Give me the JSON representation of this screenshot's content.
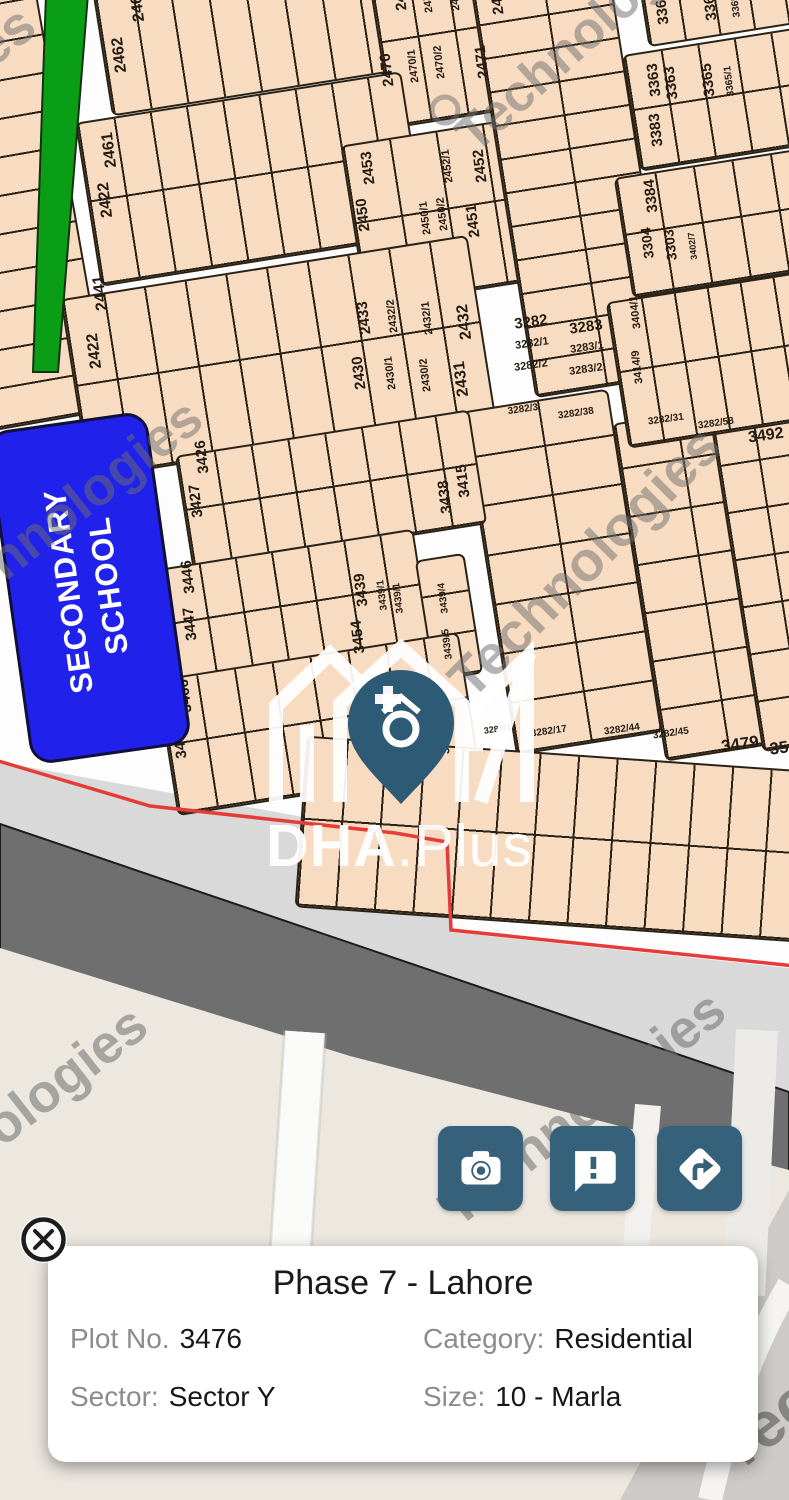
{
  "watermark": {
    "text": "Technologies"
  },
  "logo": {
    "bold": "DHA",
    "rest": ".Plus"
  },
  "school": {
    "line1": "SECONDARY",
    "line2": "SCHOOL"
  },
  "colors": {
    "plot_fill": "#f8dcc2",
    "plot_border": "#2a2216",
    "green_strip": "#0a9e17",
    "school_blue": "#2121ec",
    "road_dark": "#6f6f6f",
    "road_light": "#d9d9d9",
    "ground_beige": "#ece8e0",
    "boundary_red": "#e63c38",
    "button_teal": "#35617b"
  },
  "actions": [
    {
      "label": "camera",
      "icon": "camera-icon"
    },
    {
      "label": "feedback",
      "icon": "chat-exclaim-icon"
    },
    {
      "label": "directions",
      "icon": "turn-right-icon"
    }
  ],
  "info_card": {
    "title": "Phase 7 - Lahore",
    "fields": [
      {
        "label": "Plot No.",
        "value": "3476"
      },
      {
        "label": "Category:",
        "value": "Residential"
      },
      {
        "label": "Sector:",
        "value": "Sector Y"
      },
      {
        "label": "Size:",
        "value": "10 - Marla"
      }
    ]
  },
  "map": {
    "blocks": [
      {
        "x": -78,
        "y": -28,
        "w": 150,
        "h": 455,
        "rot": -10,
        "cols": 1,
        "rows": 12
      },
      {
        "x": 100,
        "y": -38,
        "w": 298,
        "h": 132,
        "rot": -9,
        "cols": 8,
        "rows": 1
      },
      {
        "x": 378,
        "y": -50,
        "w": 150,
        "h": 168,
        "rot": -9,
        "cols": 4,
        "rows": 2
      },
      {
        "x": 86,
        "y": 96,
        "w": 330,
        "h": 166,
        "rot": -9,
        "cols": 9,
        "rows": 2
      },
      {
        "x": 352,
        "y": 130,
        "w": 188,
        "h": 164,
        "rot": -9,
        "cols": 4,
        "rows": 2
      },
      {
        "x": 72,
        "y": 266,
        "w": 412,
        "h": 182,
        "rot": -9,
        "cols": 10,
        "rows": 2
      },
      {
        "x": 500,
        "y": -52,
        "w": 140,
        "h": 442,
        "rot": -9,
        "cols": 2,
        "rows": 13
      },
      {
        "x": 488,
        "y": 398,
        "w": 148,
        "h": 348,
        "rot": -9,
        "cols": 2,
        "rows": 7
      },
      {
        "x": 638,
        "y": 412,
        "w": 124,
        "h": 342,
        "rot": -9,
        "cols": 2,
        "rows": 7
      },
      {
        "x": 736,
        "y": 414,
        "w": 80,
        "h": 334,
        "rot": -9,
        "cols": 2,
        "rows": 7
      },
      {
        "x": 642,
        "y": -38,
        "w": 175,
        "h": 72,
        "rot": -9,
        "cols": 5,
        "rows": 1
      },
      {
        "x": 630,
        "y": 40,
        "w": 185,
        "h": 118,
        "rot": -9,
        "cols": 5,
        "rows": 2
      },
      {
        "x": 622,
        "y": 162,
        "w": 195,
        "h": 122,
        "rot": -9,
        "cols": 5,
        "rows": 2
      },
      {
        "x": 616,
        "y": 286,
        "w": 200,
        "h": 148,
        "rot": -9,
        "cols": 6,
        "rows": 2
      },
      {
        "x": 182,
        "y": 432,
        "w": 298,
        "h": 116,
        "rot": -9,
        "cols": 8,
        "rows": 2
      },
      {
        "x": 168,
        "y": 548,
        "w": 256,
        "h": 118,
        "rot": -9,
        "cols": 7,
        "rows": 2
      },
      {
        "x": 424,
        "y": 556,
        "w": 50,
        "h": 122,
        "rot": -9,
        "cols": 1,
        "rows": 3
      },
      {
        "x": 165,
        "y": 655,
        "w": 306,
        "h": 138,
        "rot": -9,
        "cols": 8,
        "rows": 2
      },
      {
        "x": 300,
        "y": 753,
        "w": 502,
        "h": 172,
        "rot": 4,
        "cols": 13,
        "rows": 2
      }
    ],
    "plot_labels": [
      {
        "t": "2462",
        "x": 120,
        "y": 55,
        "r": -97,
        "s": 16
      },
      {
        "t": "2462",
        "x": 138,
        "y": 4,
        "r": -97,
        "s": 16
      },
      {
        "t": "2461",
        "x": 110,
        "y": 150,
        "r": -97,
        "s": 16
      },
      {
        "t": "2422",
        "x": 106,
        "y": 200,
        "r": -97,
        "s": 16
      },
      {
        "t": "2441",
        "x": 101,
        "y": 293,
        "r": -97,
        "s": 16
      },
      {
        "t": "2422",
        "x": 95,
        "y": 351,
        "r": -97,
        "s": 16
      },
      {
        "t": "2470",
        "x": 387,
        "y": 70,
        "r": -97,
        "s": 15
      },
      {
        "t": "2470/1",
        "x": 414,
        "y": 66,
        "r": -97,
        "s": 11
      },
      {
        "t": "2470/2",
        "x": 440,
        "y": 62,
        "r": -97,
        "s": 11
      },
      {
        "t": "2471",
        "x": 482,
        "y": 62,
        "r": -97,
        "s": 15
      },
      {
        "t": "2472",
        "x": 400,
        "y": -6,
        "r": -97,
        "s": 15
      },
      {
        "t": "2472/1",
        "x": 428,
        "y": -4,
        "r": -97,
        "s": 11
      },
      {
        "t": "2472/2",
        "x": 455,
        "y": -6,
        "r": -97,
        "s": 11
      },
      {
        "t": "2472",
        "x": 497,
        "y": -2,
        "r": -97,
        "s": 15
      },
      {
        "t": "2453",
        "x": 368,
        "y": 168,
        "r": -97,
        "s": 15
      },
      {
        "t": "2450",
        "x": 363,
        "y": 215,
        "r": -97,
        "s": 15
      },
      {
        "t": "2450/1",
        "x": 426,
        "y": 218,
        "r": -97,
        "s": 11
      },
      {
        "t": "2450/2",
        "x": 443,
        "y": 214,
        "r": -97,
        "s": 11
      },
      {
        "t": "2452/1",
        "x": 448,
        "y": 166,
        "r": -97,
        "s": 11
      },
      {
        "t": "2452",
        "x": 480,
        "y": 166,
        "r": -97,
        "s": 15
      },
      {
        "t": "2451",
        "x": 473,
        "y": 221,
        "r": -97,
        "s": 15
      },
      {
        "t": "2433",
        "x": 364,
        "y": 318,
        "r": -97,
        "s": 15
      },
      {
        "t": "2430",
        "x": 359,
        "y": 373,
        "r": -97,
        "s": 15
      },
      {
        "t": "2432/2",
        "x": 393,
        "y": 316,
        "r": -97,
        "s": 11
      },
      {
        "t": "2430/1",
        "x": 391,
        "y": 373,
        "r": -97,
        "s": 11
      },
      {
        "t": "2432/1",
        "x": 428,
        "y": 318,
        "r": -97,
        "s": 11
      },
      {
        "t": "2430/2",
        "x": 426,
        "y": 375,
        "r": -97,
        "s": 11
      },
      {
        "t": "2432",
        "x": 465,
        "y": 322,
        "r": -97,
        "s": 16
      },
      {
        "t": "2431",
        "x": 462,
        "y": 379,
        "r": -97,
        "s": 16
      },
      {
        "t": "3282",
        "x": 531,
        "y": 322,
        "r": -8,
        "s": 15
      },
      {
        "t": "3283",
        "x": 586,
        "y": 327,
        "r": -8,
        "s": 15
      },
      {
        "t": "3282/1",
        "x": 532,
        "y": 344,
        "r": -8,
        "s": 11
      },
      {
        "t": "3283/1",
        "x": 587,
        "y": 348,
        "r": -8,
        "s": 11
      },
      {
        "t": "3282/2",
        "x": 531,
        "y": 366,
        "r": -8,
        "s": 11
      },
      {
        "t": "3283/2",
        "x": 586,
        "y": 370,
        "r": -8,
        "s": 11
      },
      {
        "t": "3282/3",
        "x": 523,
        "y": 410,
        "r": -8,
        "s": 10
      },
      {
        "t": "3282/38",
        "x": 576,
        "y": 414,
        "r": -8,
        "s": 10
      },
      {
        "t": "3282/31",
        "x": 666,
        "y": 420,
        "r": -8,
        "s": 10
      },
      {
        "t": "3282/58",
        "x": 716,
        "y": 424,
        "r": -8,
        "s": 10
      },
      {
        "t": "3282/18",
        "x": 500,
        "y": 729,
        "r": -8,
        "s": 9
      },
      {
        "t": "3282/17",
        "x": 549,
        "y": 732,
        "r": -8,
        "s": 10
      },
      {
        "t": "3282/44",
        "x": 622,
        "y": 730,
        "r": -8,
        "s": 10
      },
      {
        "t": "3282/45",
        "x": 671,
        "y": 734,
        "r": -8,
        "s": 10
      },
      {
        "t": "3479",
        "x": 740,
        "y": 744,
        "r": -8,
        "s": 17
      },
      {
        "t": "35",
        "x": 779,
        "y": 748,
        "r": -8,
        "s": 17
      },
      {
        "t": "3492",
        "x": 766,
        "y": 436,
        "r": -8,
        "s": 16
      },
      {
        "t": "3363",
        "x": 654,
        "y": 80,
        "r": -97,
        "s": 15
      },
      {
        "t": "3363",
        "x": 671,
        "y": 83,
        "r": -97,
        "s": 15
      },
      {
        "t": "3365",
        "x": 708,
        "y": 80,
        "r": -97,
        "s": 15
      },
      {
        "t": "3365/1",
        "x": 730,
        "y": 81,
        "r": -97,
        "s": 10
      },
      {
        "t": "3363",
        "x": 662,
        "y": 8,
        "r": -97,
        "s": 15
      },
      {
        "t": "3365",
        "x": 710,
        "y": 4,
        "r": -97,
        "s": 15
      },
      {
        "t": "3365/1",
        "x": 736,
        "y": 2,
        "r": -97,
        "s": 10
      },
      {
        "t": "3383",
        "x": 656,
        "y": 130,
        "r": -97,
        "s": 15
      },
      {
        "t": "3384",
        "x": 651,
        "y": 196,
        "r": -97,
        "s": 15
      },
      {
        "t": "3304",
        "x": 647,
        "y": 243,
        "r": -97,
        "s": 14
      },
      {
        "t": "3303",
        "x": 670,
        "y": 245,
        "r": -97,
        "s": 14
      },
      {
        "t": "3402/7",
        "x": 693,
        "y": 246,
        "r": -97,
        "s": 9
      },
      {
        "t": "3404/1",
        "x": 636,
        "y": 312,
        "r": -97,
        "s": 11
      },
      {
        "t": "3414/9",
        "x": 638,
        "y": 367,
        "r": -97,
        "s": 11
      },
      {
        "t": "3426",
        "x": 202,
        "y": 457,
        "r": -97,
        "s": 15
      },
      {
        "t": "3427",
        "x": 196,
        "y": 501,
        "r": -97,
        "s": 15
      },
      {
        "t": "3438",
        "x": 445,
        "y": 497,
        "r": -97,
        "s": 15
      },
      {
        "t": "3415",
        "x": 463,
        "y": 481,
        "r": -97,
        "s": 15
      },
      {
        "t": "3446",
        "x": 188,
        "y": 577,
        "r": -97,
        "s": 15
      },
      {
        "t": "3447",
        "x": 190,
        "y": 624,
        "r": -97,
        "s": 15
      },
      {
        "t": "3439",
        "x": 361,
        "y": 590,
        "r": -97,
        "s": 15
      },
      {
        "t": "3454",
        "x": 358,
        "y": 637,
        "r": -97,
        "s": 15
      },
      {
        "t": "3439/1",
        "x": 383,
        "y": 595,
        "r": -97,
        "s": 10
      },
      {
        "t": "3439/1",
        "x": 399,
        "y": 598,
        "r": -97,
        "s": 10
      },
      {
        "t": "3439/4",
        "x": 444,
        "y": 598,
        "r": -97,
        "s": 10
      },
      {
        "t": "3439/5",
        "x": 448,
        "y": 644,
        "r": -97,
        "s": 10
      },
      {
        "t": "3466",
        "x": 185,
        "y": 696,
        "r": -97,
        "s": 15
      },
      {
        "t": "3467",
        "x": 180,
        "y": 742,
        "r": -97,
        "s": 15
      },
      {
        "t": "3476",
        "x": 444,
        "y": 741,
        "r": -97,
        "s": 12
      }
    ],
    "watermarks": [
      {
        "x": -262,
        "y": 205,
        "r": -38,
        "s": 54,
        "o": 0.5
      },
      {
        "x": 444,
        "y": 120,
        "r": -42,
        "s": 52,
        "o": 0.5
      },
      {
        "x": -95,
        "y": 598,
        "r": -38,
        "s": 54,
        "o": 0.5
      },
      {
        "x": 435,
        "y": 665,
        "r": -45,
        "s": 56,
        "o": 0.5
      },
      {
        "x": -150,
        "y": 1205,
        "r": -38,
        "s": 54,
        "o": 0.55
      },
      {
        "x": 428,
        "y": 1190,
        "r": -38,
        "s": 54,
        "o": 0.55
      },
      {
        "x": 700,
        "y": 1428,
        "r": -38,
        "s": 64,
        "o": 0.75
      }
    ]
  }
}
